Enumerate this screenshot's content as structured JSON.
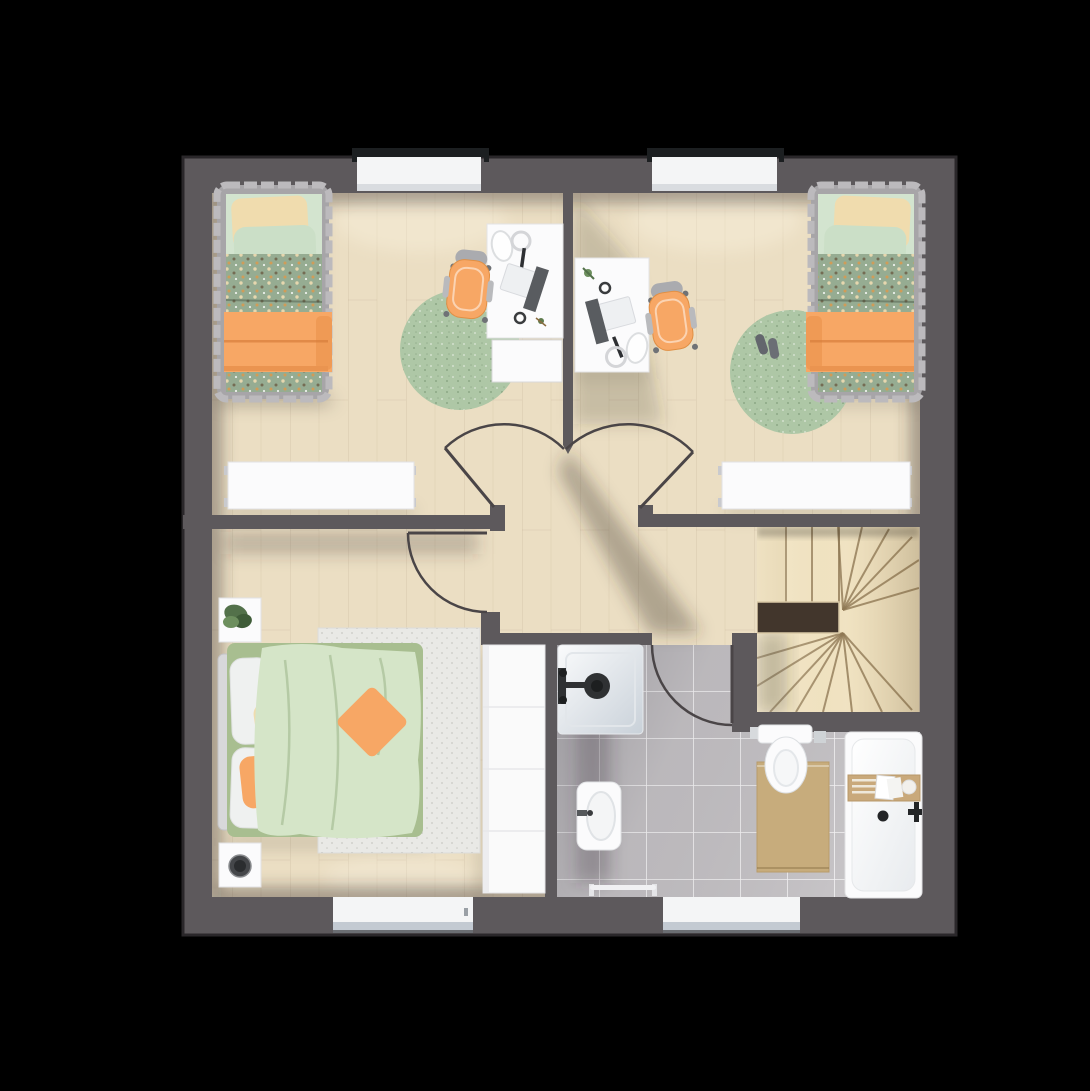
{
  "scene": {
    "type": "floor-plan-top-view",
    "storey": "upper-floor",
    "rooms": [
      {
        "id": "bedroom-top-left",
        "furniture": [
          "single-bed",
          "desk",
          "desk-chair",
          "round-rug",
          "radiator",
          "window"
        ]
      },
      {
        "id": "bedroom-top-right",
        "furniture": [
          "single-bed",
          "desk",
          "desk-chair",
          "round-rug",
          "slippers",
          "radiator",
          "window"
        ]
      },
      {
        "id": "master-bedroom",
        "furniture": [
          "double-bed",
          "nightstand-with-plant",
          "nightstand-with-speaker",
          "area-rug",
          "wardrobe",
          "window"
        ]
      },
      {
        "id": "bathroom",
        "furniture": [
          "shower",
          "sink",
          "toilet",
          "bathtub",
          "bath-caddy",
          "bath-mat",
          "towel-rail",
          "window"
        ]
      },
      {
        "id": "hallway",
        "furniture": []
      },
      {
        "id": "staircase",
        "furniture": [
          "winder-stairs",
          "banister"
        ]
      }
    ],
    "window_count": 4,
    "door_count": 4
  },
  "colors": {
    "bg": "#000000",
    "wall": "#5d595c",
    "wall_outline": "#292628",
    "wood": "#ebdec3",
    "tile": "#c1bec1",
    "stair": "#f3e6c6",
    "stair_entry": "#e9dab7",
    "banister": "#42362c",
    "white_furniture": "#fbfbfc",
    "window_sill": "#f4f5f6",
    "window_lintel": "#1c1f21",
    "orange": "#f7a765",
    "orange_deep": "#ef9a55",
    "sage": "#96ac92",
    "mint": "#d3e4cf",
    "cream": "#f0dcae",
    "duvet_green": "#d5e5c8",
    "bed_base_green": "#a8be90",
    "rug_green": "#aec7a6",
    "rug_white": "#e9e9e6",
    "mat_tan": "#c7ac7c",
    "caddy_wood": "#c9a97b",
    "chair_gray": "#aaabaf",
    "arc": "#4a4547",
    "dark_fixture": "#2f3133"
  }
}
